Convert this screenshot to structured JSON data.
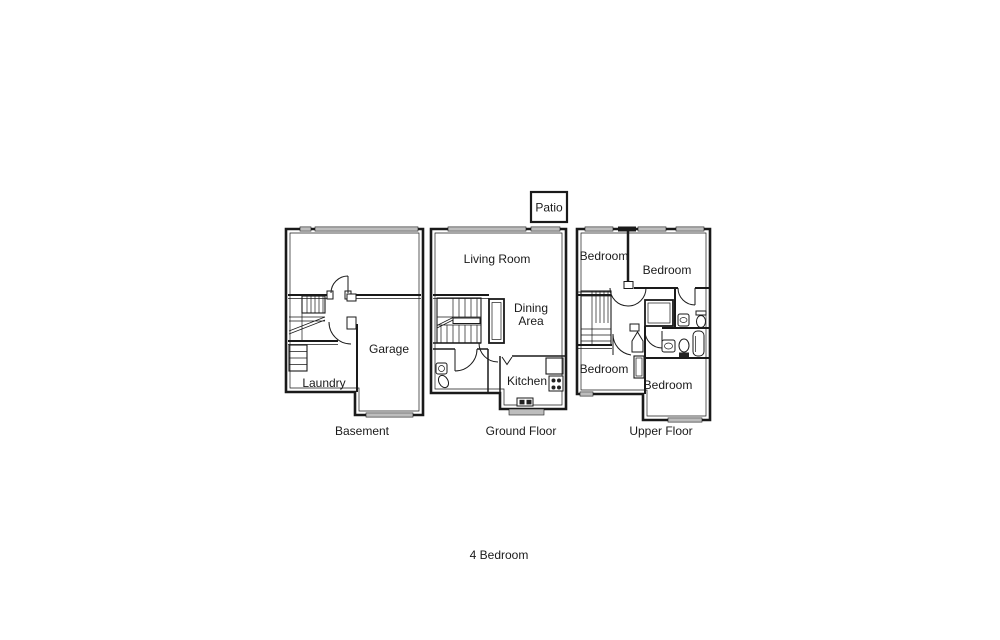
{
  "summary_caption": "4 Bedroom",
  "patio": {
    "label": "Patio"
  },
  "floors": {
    "basement": {
      "caption": "Basement",
      "rooms": {
        "garage": "Garage",
        "laundry": "Laundry"
      }
    },
    "ground": {
      "caption": "Ground Floor",
      "rooms": {
        "living_room": "Living Room",
        "dining_area": {
          "line1": "Dining",
          "line2": "Area"
        },
        "kitchen": "Kitchen"
      }
    },
    "upper": {
      "caption": "Upper Floor",
      "rooms": {
        "bedroom_top_left": "Bedroom",
        "bedroom_top_right": "Bedroom",
        "bedroom_bottom_left": "Bedroom",
        "bedroom_bottom_right": "Bedroom"
      }
    }
  },
  "colors": {
    "wall": "#1a1a1a",
    "window_fill": "#bdbdbd",
    "background": "#ffffff"
  }
}
